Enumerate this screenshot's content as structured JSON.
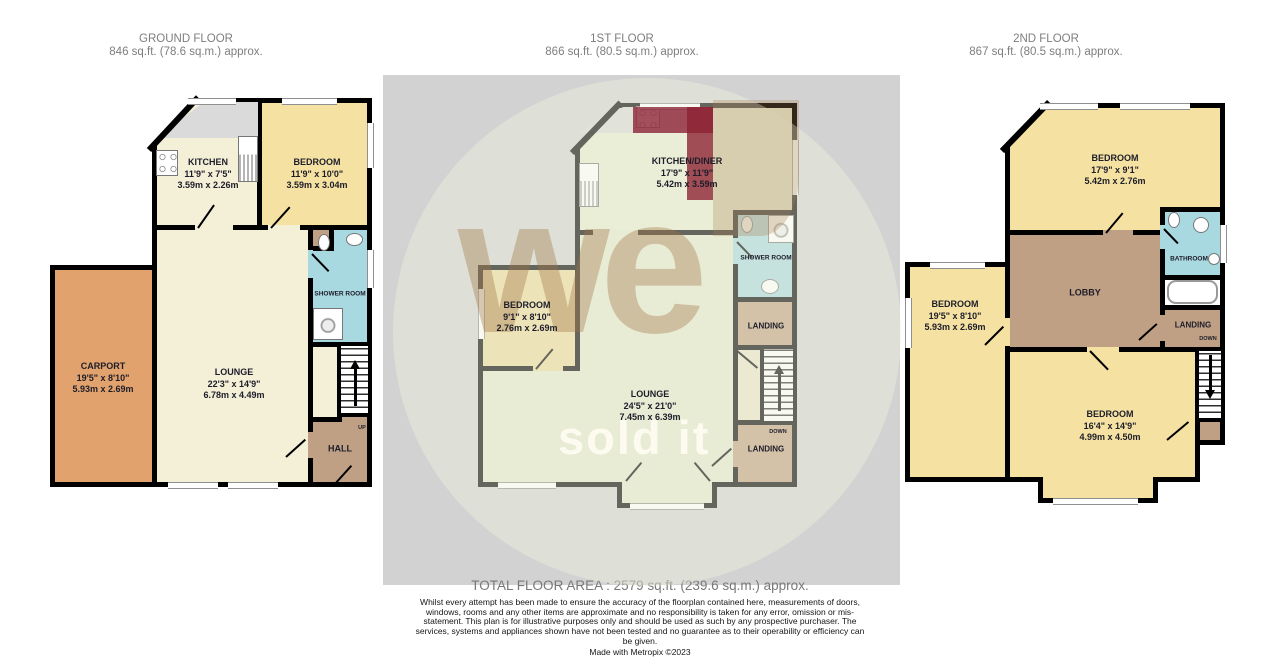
{
  "headers": [
    {
      "title": "GROUND FLOOR",
      "area": "846 sq.ft. (78.6 sq.m.) approx."
    },
    {
      "title": "1ST FLOOR",
      "area": "866 sq.ft. (80.5 sq.m.) approx."
    },
    {
      "title": "2ND FLOOR",
      "area": "867 sq.ft. (80.5 sq.m.) approx."
    }
  ],
  "rooms": {
    "g_kitchen": {
      "name": "KITCHEN",
      "imperial": "11'9\" x 7'5\"",
      "metric": "3.59m x 2.26m"
    },
    "g_bedroom": {
      "name": "BEDROOM",
      "imperial": "11'9\" x 10'0\"",
      "metric": "3.59m x 3.04m"
    },
    "g_shower": {
      "name": "SHOWER ROOM"
    },
    "g_carport": {
      "name": "CARPORT",
      "imperial": "19'5\" x 8'10\"",
      "metric": "5.93m x 2.69m"
    },
    "g_lounge": {
      "name": "LOUNGE",
      "imperial": "22'3\" x 14'9\"",
      "metric": "6.78m x 4.49m"
    },
    "g_hall": {
      "name": "HALL"
    },
    "f_kitchen": {
      "name": "KITCHEN/DINER",
      "imperial": "17'9\" x 11'9\"",
      "metric": "5.42m x 3.59m"
    },
    "f_bedroom": {
      "name": "BEDROOM",
      "imperial": "9'1\" x 8'10\"",
      "metric": "2.76m x 2.69m"
    },
    "f_shower": {
      "name": "SHOWER ROOM"
    },
    "f_landing_u": {
      "name": "LANDING"
    },
    "f_landing_l": {
      "name": "LANDING"
    },
    "f_lounge": {
      "name": "LOUNGE",
      "imperial": "24'5\" x 21'0\"",
      "metric": "7.45m x 6.39m"
    },
    "s_bed_top": {
      "name": "BEDROOM",
      "imperial": "17'9\" x 9'1\"",
      "metric": "5.42m x 2.76m"
    },
    "s_bathroom": {
      "name": "BATHROOM"
    },
    "s_lobby": {
      "name": "LOBBY"
    },
    "s_landing": {
      "name": "LANDING"
    },
    "s_bed_left": {
      "name": "BEDROOM",
      "imperial": "19'5\" x 8'10\"",
      "metric": "5.93m x 2.69m"
    },
    "s_bed_bottom": {
      "name": "BEDROOM",
      "imperial": "16'4\" x 14'9\"",
      "metric": "4.99m x 4.50m"
    }
  },
  "labels": {
    "up": "UP",
    "down": "DOWN"
  },
  "watermark": {
    "word1": "we",
    "word2": "sold it"
  },
  "footer": {
    "total": "TOTAL FLOOR AREA : 2579 sq.ft. (239.6 sq.m.) approx.",
    "disclaimer": "Whilst every attempt has been made to ensure the accuracy of the floorplan contained here, measurements of doors, windows, rooms and any other items are approximate and no responsibility is taken for any error, omission or mis-statement. This plan is for illustrative purposes only and should be used as such by any prospective purchaser. The services, systems and appliances shown have not been tested and no guarantee as to their operability or efficiency can be given.",
    "made_with": "Made with Metropix ©2023"
  },
  "colors": {
    "wall": "#000000",
    "cream": "#f4efd7",
    "yellow": "#f5e2a2",
    "carport_orange": "#e2a26d",
    "wet_blue": "#a8d8e0",
    "hall_brown": "#bfa084",
    "panel_grey": "#d2d2d2",
    "counter_grey": "#dadada"
  }
}
